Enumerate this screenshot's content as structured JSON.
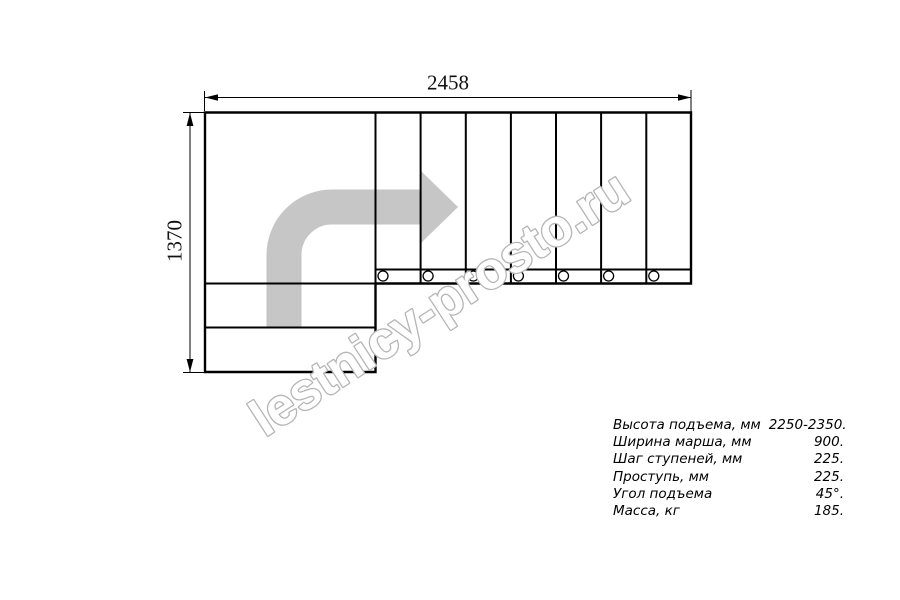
{
  "drawing": {
    "dim_width_label": "2458",
    "dim_height_label": "1370",
    "watermark_text": "lestnicy-prosto.ru"
  },
  "specs": {
    "rows": [
      {
        "label": "Высота подъема, мм",
        "value": "2250-2350."
      },
      {
        "label": "Ширина марша, мм",
        "value": "900."
      },
      {
        "label": "Шаг ступеней, мм",
        "value": "225."
      },
      {
        "label": "Проступь, мм",
        "value": "225."
      },
      {
        "label": "Угол подъема",
        "value": "45°."
      },
      {
        "label": "Масса, кг",
        "value": "185."
      }
    ]
  },
  "colors": {
    "line": "#000000",
    "direction_arrow_gray": "#c6c6c6",
    "watermark_stroke_gray": "#b5b5b5",
    "background": "#ffffff"
  }
}
